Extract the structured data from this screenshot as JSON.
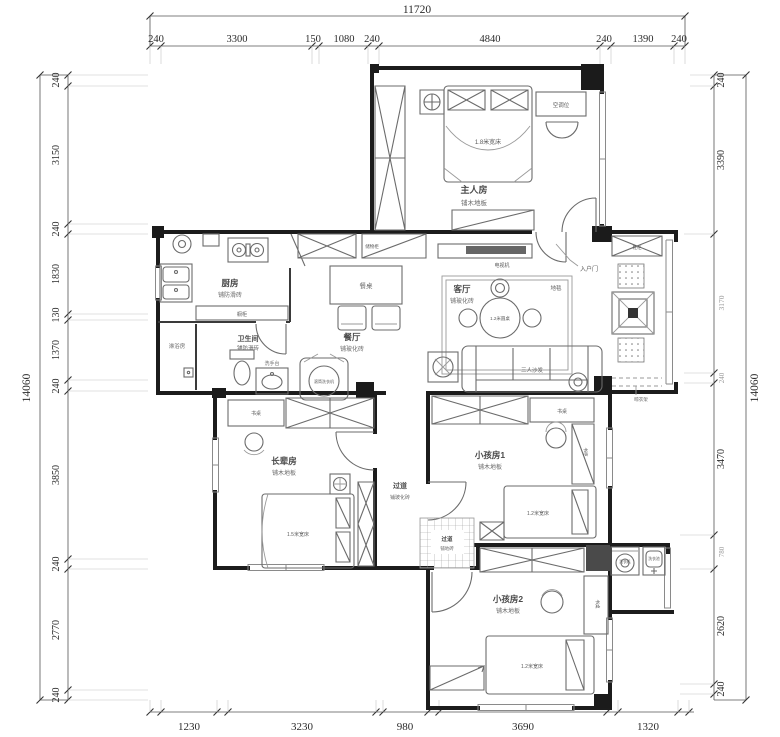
{
  "drawing": {
    "kind": "apartment-floor-plan",
    "unit": "mm"
  },
  "colors": {
    "wall": "#1c1c1c",
    "furniture": "#6b6b6b",
    "dimension": "#2b2b2b",
    "background": "#ffffff"
  },
  "dimensions": {
    "top": {
      "total": "11720",
      "segments": [
        "240",
        "3300",
        "150",
        "1080",
        "240",
        "4840",
        "240",
        "1390",
        "240"
      ]
    },
    "left": {
      "total": "14060",
      "segments": [
        "240",
        "3150",
        "240",
        "1830",
        "130",
        "1370",
        "240",
        "3850",
        "240",
        "2770",
        "240"
      ]
    },
    "right": {
      "total": "14060",
      "segments": [
        "240",
        "3390",
        "3170",
        "240",
        "3470",
        "780",
        "2620",
        "240"
      ]
    },
    "bottom": {
      "segments": [
        "1230",
        "3230",
        "980",
        "3690",
        "1320"
      ]
    }
  },
  "rooms": {
    "master": {
      "name": "主人房",
      "floor": "铺木地板",
      "bed": "1.8米宽床",
      "ac_shelf": "空调位"
    },
    "kitchen": {
      "name": "厨房",
      "floor": "铺防滑砖",
      "cabinet": "橱柜"
    },
    "bathroom": {
      "name": "卫生间",
      "floor": "铺防滑砖",
      "shower": "淋浴房",
      "basin": "洗手台"
    },
    "dining": {
      "name": "餐厅",
      "floor": "铺玻化砖",
      "table": "餐桌",
      "cabinet": "储物柜",
      "washer": "滚筒洗衣机"
    },
    "living": {
      "name": "客厅",
      "floor": "铺玻化砖",
      "sofa": "三人沙发",
      "round_table": "1.2米圆桌",
      "rug": "地毯",
      "tv": "电视机",
      "entry_door": "入户门",
      "shoe_cabinet": "鞋柜",
      "drying_rack": "晾衣架"
    },
    "elder": {
      "name": "长辈房",
      "floor": "铺木地板",
      "bed": "1.5米宽床",
      "desk": "书桌"
    },
    "kid1": {
      "name": "小孩房1",
      "floor": "铺木地板",
      "bed": "1.2米宽床",
      "desk": "书桌",
      "bookcase": "书柜"
    },
    "kid2": {
      "name": "小孩房2",
      "floor": "铺木地板",
      "bed": "1.2米宽床",
      "desk": "书桌"
    },
    "hall": {
      "name": "过道",
      "floor": "铺玻化砖"
    },
    "hall2": {
      "name": "过道",
      "floor": "铺地砖"
    },
    "laundry": {
      "washer": "洗衣机",
      "sink": "洗衣池"
    }
  }
}
